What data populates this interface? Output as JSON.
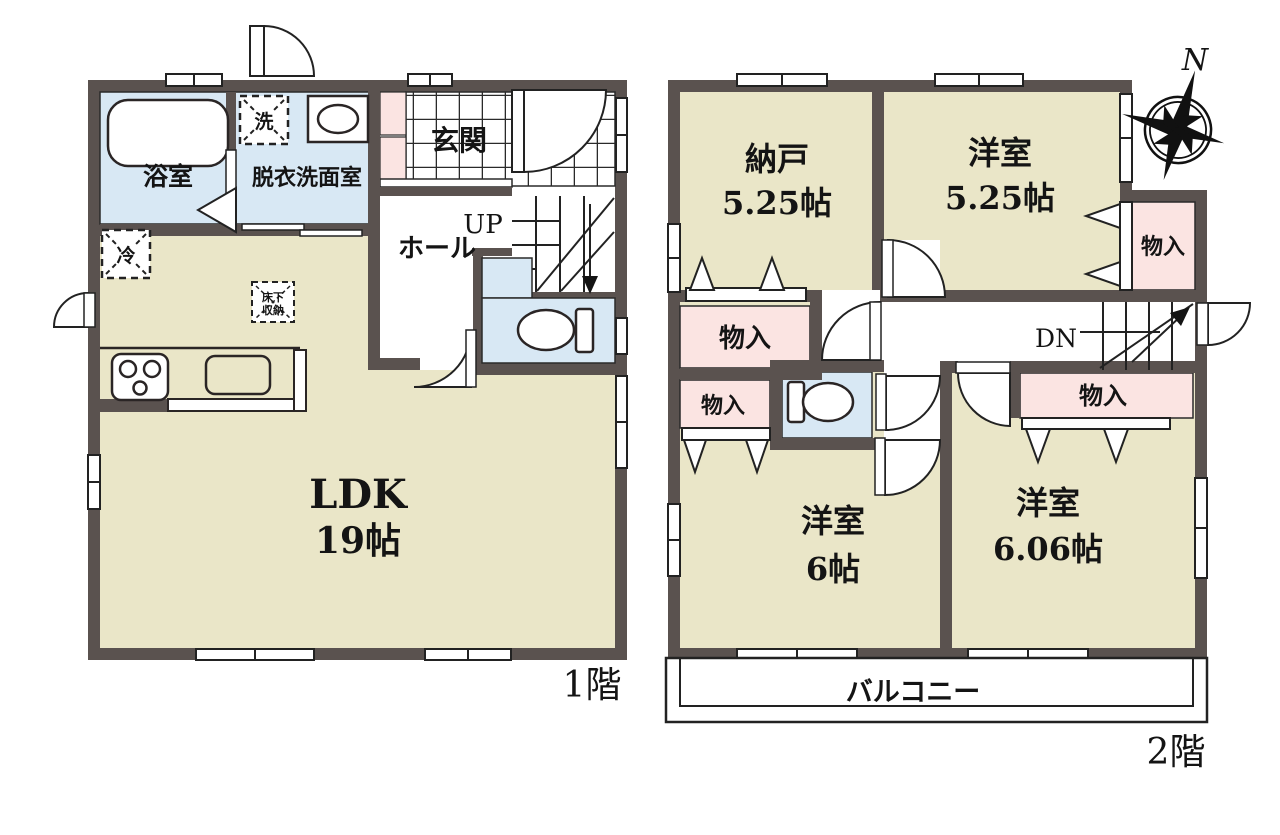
{
  "doc": {
    "type": "floor-plan"
  },
  "colors": {
    "wall": "#5a524f",
    "room_beige": "#eae6c8",
    "wet_blue": "#d8e8f4",
    "closet_pink": "#fbe4e2",
    "line": "#222222"
  },
  "floor1": {
    "floor_label": "1階",
    "bath": "浴室",
    "washroom": "脱衣洗面室",
    "washer": "洗",
    "entrance": "玄関",
    "hall": "ホール",
    "up": "UP",
    "fridge": "冷",
    "underfloor1": "床下",
    "underfloor2": "収納",
    "ldk_name": "LDK",
    "ldk_size": "19帖"
  },
  "floor2": {
    "floor_label": "2階",
    "north": "N",
    "storage_name": "納戸",
    "storage_size": "5.25帖",
    "west1_name": "洋室",
    "west1_size": "5.25帖",
    "west2_name": "洋室",
    "west2_size": "6帖",
    "west3_name": "洋室",
    "west3_size": "6.06帖",
    "closet_right": "物入",
    "closet_hall": "物入",
    "closet_small": "物入",
    "closet_606": "物入",
    "dn": "DN",
    "balcony": "バルコニー"
  }
}
